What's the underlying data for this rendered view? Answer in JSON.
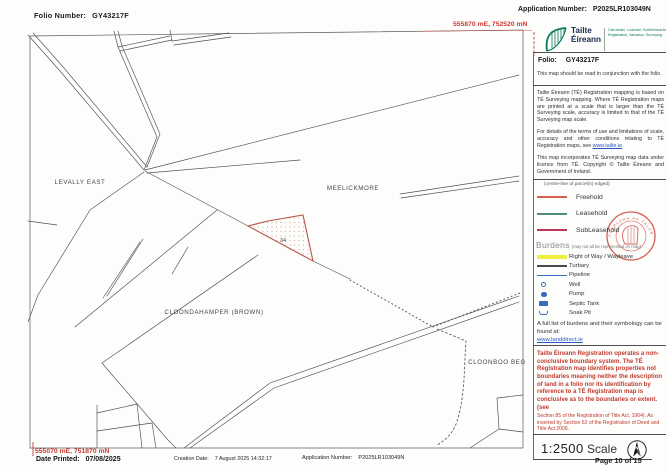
{
  "header": {
    "folio_label": "Folio Number:",
    "folio_value": "GY43217F",
    "application_label": "Application Number:",
    "application_value": "P2025LR103049N",
    "grid_ref_top_right": "555870 mE, 752520 mN"
  },
  "map": {
    "townlands": [
      "LEVALLY EAST",
      "MEELICKMORE",
      "CLOONDAHAMPER (BROWN)",
      "CLOONBOO BEG"
    ],
    "parcel_number": "34",
    "parcel_edge_color": "#b5544a"
  },
  "sidebar": {
    "logo": {
      "name_line1": "Tailte",
      "name_line2": "Éireann",
      "tagline_irish": "Clárúcháin, Luacháil, Suirbhéireacht",
      "tagline_english": "Registration, Valuation, Surveying",
      "brand_green": "#0b7a5c"
    },
    "folio_label": "Folio:",
    "folio_value": "GY43217F",
    "note_intro": "This map should be read in conjunction with the folio.",
    "para_accuracy": "Tailte Éireann (TÉ) Registration mapping is based on TÉ Surveying mapping. Where TÉ Registration maps are printed at a scale that is larger than the TÉ Surveying scale, accuracy is limited to that of the TÉ Surveying map scale.",
    "para_terms_pre": "For details of the terms of use and limitations of scale, accuracy and other conditions relating to TÉ Registration maps, see ",
    "para_terms_link": "www.tailte.ie",
    "para_terms_post": ".",
    "para_copyright": "This map incorporates TÉ Surveying map data under licence from TÉ. Copyright © Tailte Éireann and Government of Ireland.",
    "legend_note": "(centre-line of parcel(s) edged)",
    "tenure": [
      {
        "label": "Freehold",
        "color": "#d95f52"
      },
      {
        "label": "Leasehold",
        "color": "#4f8f7a"
      },
      {
        "label": "SubLeasehold",
        "color": "#b8365c"
      }
    ],
    "seal_text": "CLÁRLANN NA TALÚN",
    "burdens_title": "Burdens",
    "burdens_note": "(may not all be represented on map)",
    "burdens": [
      {
        "label": "Right of Way / Wayleave",
        "symbol": "yellow-band",
        "color": "#f2ee3f"
      },
      {
        "label": "Turbary",
        "symbol": "dark-band",
        "color": "#4a4a4a"
      },
      {
        "label": "Pipeline",
        "symbol": "blue-line",
        "color": "#3a6abf"
      },
      {
        "label": "Well",
        "symbol": "open-circle",
        "color": "#3a6abf"
      },
      {
        "label": "Pump",
        "symbol": "filled-circle",
        "color": "#3a6abf"
      },
      {
        "label": "Septic Tank",
        "symbol": "filled-rect",
        "color": "#3a6abf"
      },
      {
        "label": "Soak Pit",
        "symbol": "open-dish",
        "color": "#3a6abf"
      }
    ],
    "full_list_text": "A full list of burdens and their symbology can be found at:",
    "full_list_link": "www.landdirect.ie",
    "disclaimer_bold": "Tailte Éireann Registration operates a non-conclusive boundary system. The TÉ Registration map identifies properties not boundaries meaning neither the description of land in a folio nor its identification by reference to a TÉ Registration map is conclusive as to the boundaries or extent. (see",
    "disclaimer_small": "Section 85 of the Registration of Title Act, 1964). As inserted by Section 62 of the Registration of Deed and Title Act 2006.",
    "disclaimer_color": "#c13b2e",
    "scale_value": "1:2500",
    "scale_word": "Scale",
    "north_label": "N",
    "page_info": "Page 10 of 15"
  },
  "footer": {
    "grid_ref_bottom_left": "555070 mE, 751870 mN",
    "date_printed_label": "Date Printed:",
    "date_printed_value": "07/08/2025",
    "creation_label": "Creation Date:",
    "creation_value": "7 August 2025 14:32:17",
    "application_label": "Application Number:",
    "application_value": "P2025LR103049N"
  }
}
